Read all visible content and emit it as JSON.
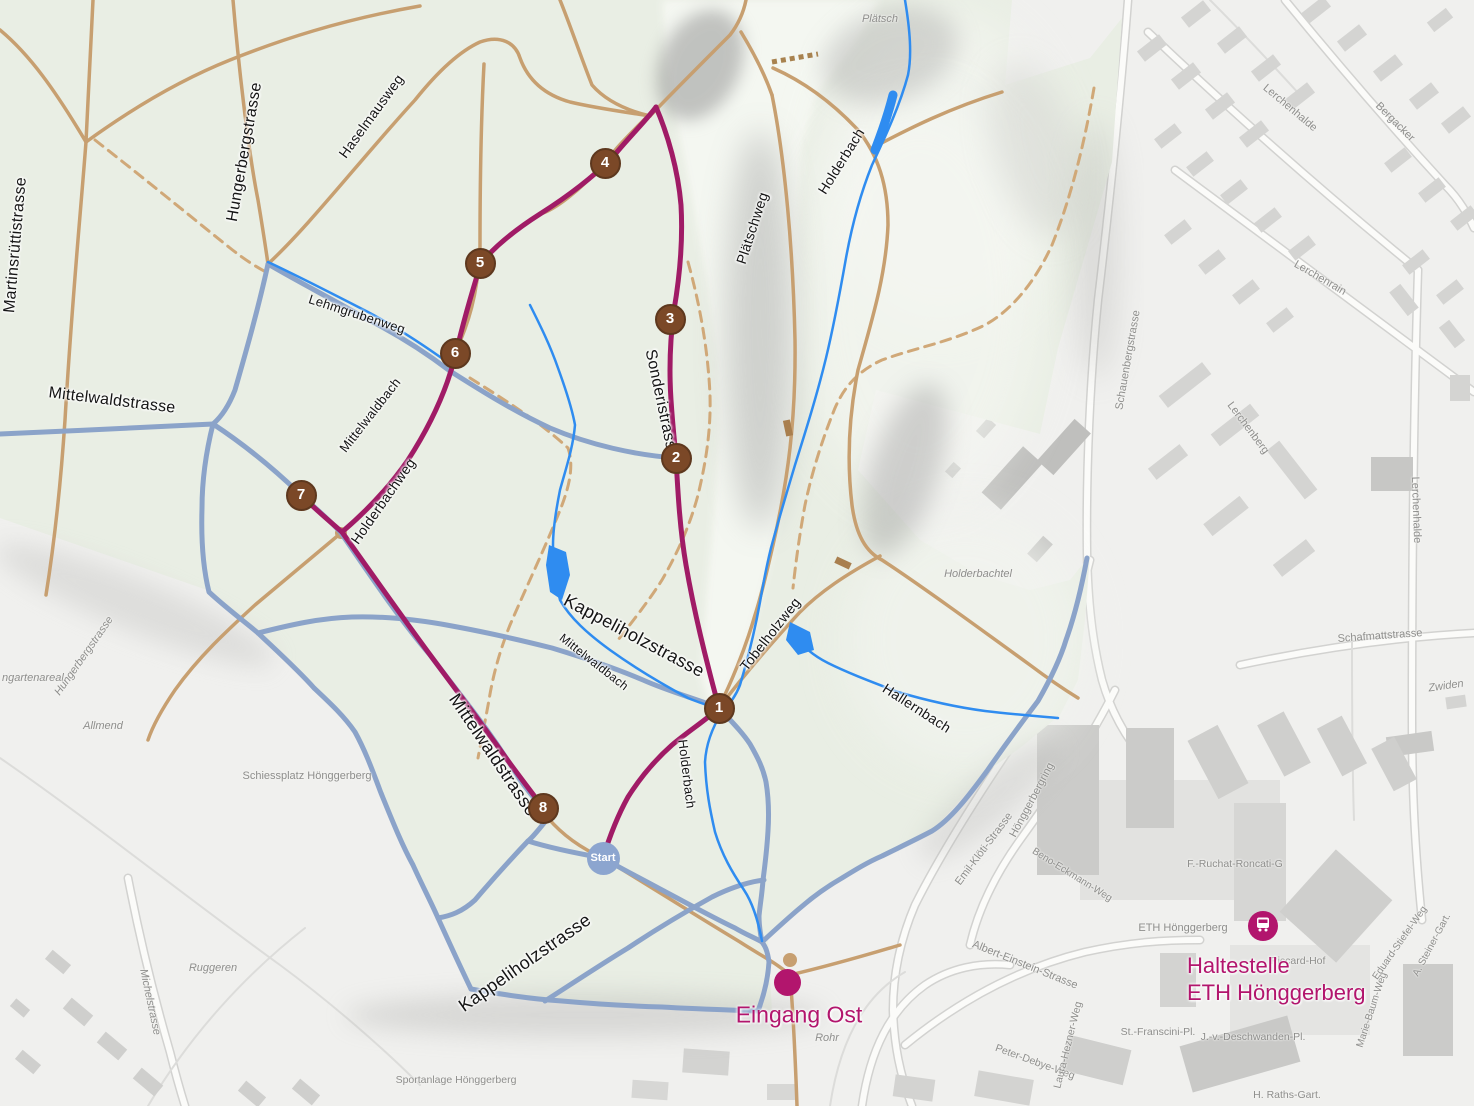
{
  "colors": {
    "route": "#a01b66",
    "marker": "#7b4827",
    "trail_path": "#8ba3c9",
    "forest_road": "#c79f70",
    "water": "#2f8cf0",
    "reserve_fill": "#e9eee4",
    "city_fill": "#f0f0ee",
    "poi_magenta": "#b2156d",
    "start_fill": "#8ca5cf"
  },
  "route": {
    "start_label": "Start",
    "waypoints": [
      {
        "label": "1"
      },
      {
        "label": "2"
      },
      {
        "label": "3"
      },
      {
        "label": "4"
      },
      {
        "label": "5"
      },
      {
        "label": "6"
      },
      {
        "label": "7"
      },
      {
        "label": "8"
      }
    ]
  },
  "poi": {
    "eingang_ost": "Eingang Ost",
    "bus_stop_line1": "Haltestelle",
    "bus_stop_line2": "ETH Hönggerberg",
    "bus_icon": "bus-icon"
  },
  "street_labels": {
    "martinsruettistrasse": "Martinsrüttistrasse",
    "hungerbergstrasse": "Hungerbergstrasse",
    "haselmausweg": "Haselmausweg",
    "lehmgrubenweg": "Lehmgrubenweg",
    "mittelwaldstrasse_west": "Mittelwaldstrasse",
    "mittelwaldstrasse_big": "Mittelwaldstrasse",
    "mittelwaldbach_upper": "Mittelwaldbach",
    "mittelwaldbach_lower": "Mittelwaldbach",
    "holderbachweg": "Holderbachweg",
    "sonderistrasse": "Sonderistrasse",
    "plaetschweg": "Plätschweg",
    "holderbach_upper": "Holderbach",
    "holderbach_lower": "Holderbach",
    "kappeliholzstrasse_upper": "Kappeliholzstrasse",
    "kappeliholzstrasse_lower": "Kappeliholzstrasse",
    "tobelholzweg": "Tobelholzweg",
    "hallernbach": "Hallernbach"
  },
  "background_labels": {
    "plaetsch": "Plätsch",
    "holderbachtel": "Holderbachtel",
    "allmend": "Allmend",
    "gartenareal": "ngartenareal",
    "hungerbergstrasse_small": "Hungerbergstrasse",
    "schiessplatz": "Schiessplatz Hönggerberg",
    "ruggeren": "Ruggeren",
    "sportanlage": "Sportanlage Hönggerberg",
    "michelstrasse": "Michelstrasse",
    "rohr": "Rohr",
    "eth_hoenggerberg": "ETH Hönggerberg",
    "f_ruchat_roncati": "F.-Ruchat-Roncati-G",
    "piccard_hof": "Piccard-Hof",
    "franscini_pl": "St.-Franscini-Pl.",
    "deschwanden_pl": "J.-v.-Deschwanden-Pl.",
    "raths_gart": "H. Raths-Gart.",
    "peter_debye_weg": "Peter-Debye-Weg",
    "laura_hezner_weg": "Laura-Hezner-Weg",
    "marie_baum_weg": "Marie-Baum-Weg",
    "eduard_stiefel_weg": "Eduard-Stiefel-Weg",
    "a_steiner_gart": "A. Steiner-Gart.",
    "emil_kloeti_strasse": "Emil-Klöti-Strasse",
    "hoenggerbergring": "Hönggerbergring",
    "beno_eckmann_weg": "Beno-Eckmann-Weg",
    "albert_einstein_strasse": "Albert-Einstein-Strasse",
    "schauenbergstrasse": "Schauenbergstrasse",
    "lerchenhalde_upper": "Lerchenhalde",
    "lerchenhalde_lower": "Lerchenhalde",
    "bergacker": "Bergacker",
    "lerchenrain": "Lerchenrain",
    "lerchenberg": "Lerchenberg",
    "schafmattstrasse": "Schafmattstrasse",
    "zwiden": "Zwiden"
  }
}
